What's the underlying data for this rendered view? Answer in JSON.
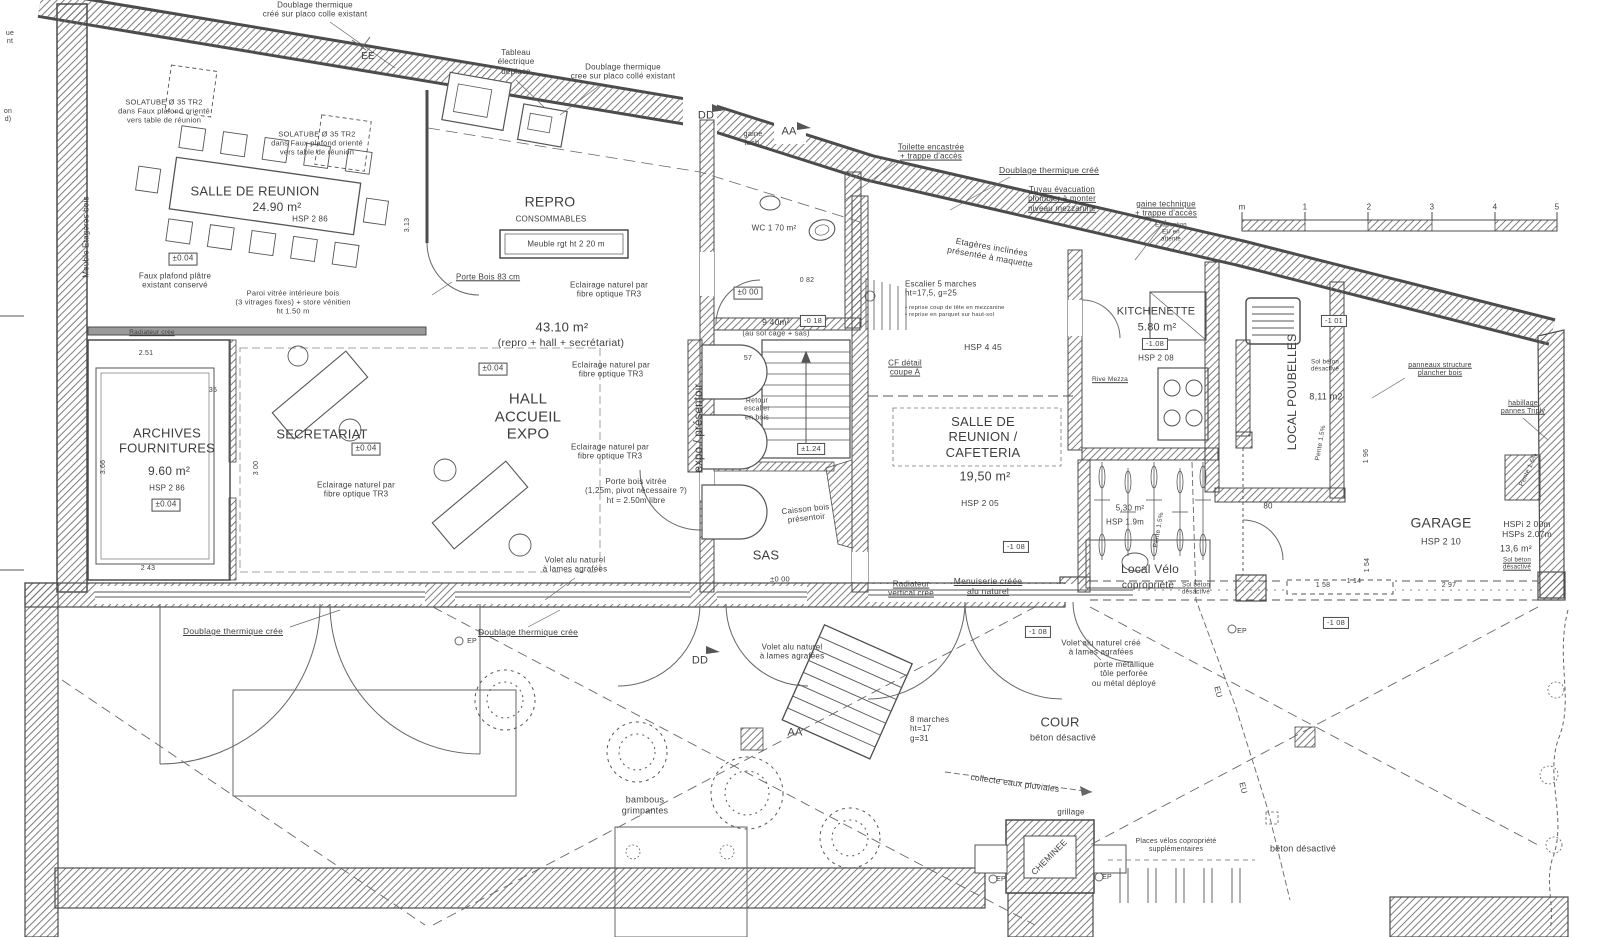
{
  "document": {
    "kind": "scanned architectural ground-floor plan (French)",
    "ink_color": "#3e3e3e",
    "paper_color": "#ffffff"
  },
  "scale_bar": {
    "unit": "m",
    "ticks": [
      "m",
      "1",
      "2",
      "3",
      "4",
      "5"
    ]
  },
  "rooms": [
    {
      "name": "SALLE DE REUNION",
      "area": "24.90 m²",
      "hsp": "HSP 2 86",
      "level": "±0.04"
    },
    {
      "name": "REPRO CONSOMMABLES"
    },
    {
      "name": "HALL ACCUEIL EXPO",
      "area": "43.10 m² (repro + hall + secrétariat)",
      "level": "±0.04"
    },
    {
      "name": "ARCHIVES FOURNITURES",
      "area": "9.60 m²",
      "hsp": "HSP 2 86",
      "level": "±0.04"
    },
    {
      "name": "SECRETARIAT",
      "level": "±0.04"
    },
    {
      "name": "WC",
      "area": "1 70 m²",
      "level": "±0 00"
    },
    {
      "name": "SALLE DE REUNION / CAFETERIA",
      "area": "19,50 m²",
      "hsp": "HSP 2 05"
    },
    {
      "name": "KITCHENETTE",
      "area": "5.80 m²",
      "hsp": "HSP 2 08",
      "level": "-1.08"
    },
    {
      "name": "SAS",
      "level": "±0 00"
    },
    {
      "name": "Local Vélo copropriété",
      "area": "5,30 m²",
      "hsp": "HSP 1.9m"
    },
    {
      "name": "LOCAL POUBELLES",
      "area": "8,11 m2",
      "level": "-1 01"
    },
    {
      "name": "GARAGE",
      "area": "13,6 m²",
      "hsp": "HSP 2 10",
      "level": "-1 08"
    },
    {
      "name": "COUR béton désactivé",
      "level": "-1 08"
    }
  ],
  "labels": [
    {
      "n": "note-doublage-top",
      "t": "Doublage thermique\ncréé sur placo colle existant",
      "x": 315,
      "y": 10,
      "s": 8
    },
    {
      "n": "marker-ee",
      "t": "EE",
      "x": 368,
      "y": 57,
      "s": 10
    },
    {
      "n": "note-solatube-1",
      "t": "SOLATUBE Ø 35     TR2\ndans Faux plafond orienté\nvers table de réunion",
      "x": 164,
      "y": 112,
      "s": 7.5
    },
    {
      "n": "note-solatube-2",
      "t": "SOLATUBE Ø 35    TR2\ndans Faux plafond orienté\nvers table de réunion",
      "x": 317,
      "y": 144,
      "s": 7.5
    },
    {
      "n": "room-salle-reunion",
      "t": "SALLE DE REUNION",
      "x": 255,
      "y": 191,
      "s": 13
    },
    {
      "n": "area-salle-reunion",
      "t": "24.90 m²",
      "x": 277,
      "y": 207,
      "s": 12
    },
    {
      "n": "hsp-salle-reunion",
      "t": "HSP 2 86",
      "x": 310,
      "y": 219,
      "s": 8
    },
    {
      "n": "lvl-reunion",
      "t": "±0.04",
      "x": 183,
      "y": 259,
      "s": 8,
      "b": true
    },
    {
      "n": "note-faux-plafond",
      "t": "Faux plafond plâtre\nexistant conservé",
      "x": 175,
      "y": 281,
      "s": 8
    },
    {
      "n": "lbl-meuble-etageres",
      "t": "Meuble Etagères bois",
      "x": 86,
      "y": 237,
      "s": 8,
      "r": -90
    },
    {
      "n": "frag-left-1",
      "t": "ue\nnt",
      "x": 10,
      "y": 38,
      "s": 7
    },
    {
      "n": "frag-left-2",
      "t": "on\nd)",
      "x": 8,
      "y": 116,
      "s": 7
    },
    {
      "n": "note-paroi-vitree",
      "t": "Paroi vitrée intérieure bois\n(3 vitrages fixes) + store vénitien\nht   1.50 m",
      "x": 293,
      "y": 303,
      "s": 7.5
    },
    {
      "n": "note-radiateur-cree",
      "t": "Radiateur crée",
      "x": 152,
      "y": 333,
      "s": 6.5,
      "u": true
    },
    {
      "n": "note-tableau-electrique",
      "t": "Tableau\nélectrique\ndéplace",
      "x": 516,
      "y": 62,
      "s": 8
    },
    {
      "n": "note-doublage-repro",
      "t": "Doublage thermique\ncree sur placo collé existant",
      "x": 623,
      "y": 72,
      "s": 8
    },
    {
      "n": "room-repro",
      "t": "REPRO",
      "x": 550,
      "y": 202,
      "s": 14
    },
    {
      "n": "sub-repro",
      "t": "CONSOMMABLES",
      "x": 551,
      "y": 219,
      "s": 8
    },
    {
      "n": "lbl-meuble-rgt",
      "t": "Meuble rgt   ht    2 20 m",
      "x": 566,
      "y": 244,
      "s": 8
    },
    {
      "n": "note-porte-bois-83",
      "t": "Porte Bois 83 cm",
      "x": 488,
      "y": 277,
      "s": 8,
      "u": true
    },
    {
      "n": "note-tr3-a",
      "t": "Eclairage naturel par\nfibre optique TR3",
      "x": 609,
      "y": 290,
      "s": 8
    },
    {
      "n": "area-hall",
      "t": "43.10 m²",
      "x": 562,
      "y": 327,
      "s": 13
    },
    {
      "n": "area-hall-sub",
      "t": "(repro + hall + secrétariat)",
      "x": 561,
      "y": 343,
      "s": 10.5
    },
    {
      "n": "lvl-hall",
      "t": "±0.04",
      "x": 493,
      "y": 369,
      "s": 8,
      "b": true
    },
    {
      "n": "room-hall",
      "t": "HALL\nACCUEIL\nEXPO",
      "x": 528,
      "y": 417,
      "s": 15
    },
    {
      "n": "note-tr3-b",
      "t": "Eclairage naturel par\nfibre optique TR3",
      "x": 611,
      "y": 370,
      "s": 8
    },
    {
      "n": "note-tr3-c",
      "t": "Eclairage naturel par\nfibre optique TR3",
      "x": 610,
      "y": 452,
      "s": 8
    },
    {
      "n": "note-porte-vitree",
      "t": "Porte bois vitrée\n(1,25m, pivot nécessaire ?)\nht = 2.50m   libre",
      "x": 636,
      "y": 491,
      "s": 8
    },
    {
      "n": "lbl-expo-presentoir",
      "t": "expo / présentoir",
      "x": 700,
      "y": 428,
      "s": 11.5,
      "r": -90
    },
    {
      "n": "marker-dd-top",
      "t": "DD",
      "x": 706,
      "y": 116,
      "s": 11
    },
    {
      "n": "lbl-gaine-tech",
      "t": "gaine\ntech.",
      "x": 753,
      "y": 139,
      "s": 7.5
    },
    {
      "n": "marker-aa-top",
      "t": "AA",
      "x": 789,
      "y": 132,
      "s": 11
    },
    {
      "n": "room-wc",
      "t": "WC   1 70 m²",
      "x": 774,
      "y": 228,
      "s": 8
    },
    {
      "n": "lvl-000-cage",
      "t": "±0 00",
      "x": 748,
      "y": 293,
      "s": 8,
      "b": true
    },
    {
      "n": "dim-082",
      "t": "0 82",
      "x": 807,
      "y": 281,
      "s": 7
    },
    {
      "n": "area-cage",
      "t": "9 40m²",
      "x": 776,
      "y": 322,
      "s": 8.5
    },
    {
      "n": "lvl-018",
      "t": "-0 18",
      "x": 813,
      "y": 321,
      "s": 7.5,
      "b": true
    },
    {
      "n": "sub-cage",
      "t": "(au sol   cage + sas)",
      "x": 776,
      "y": 334,
      "s": 7.5
    },
    {
      "n": "dim-57",
      "t": "57",
      "x": 748,
      "y": 359,
      "s": 7
    },
    {
      "n": "note-toilette",
      "t": "Toilette encastrée\n+ trappe d'accès",
      "x": 931,
      "y": 152,
      "s": 8,
      "u": true
    },
    {
      "n": "note-doublage-cree",
      "t": "Doublage thermique créé",
      "x": 1049,
      "y": 170,
      "s": 8.5,
      "u": true
    },
    {
      "n": "note-tuyau",
      "t": "Tuyau évacuation\nplombier à monter\nniveau mezzanine",
      "x": 1062,
      "y": 199,
      "s": 8,
      "u": true
    },
    {
      "n": "note-gaine-technique",
      "t": "gaine technique\n+ trappe d'accès",
      "x": 1166,
      "y": 209,
      "s": 8,
      "u": true
    },
    {
      "n": "note-evac-eu",
      "t": "Evacuation\nEU en\nattente",
      "x": 1171,
      "y": 233,
      "s": 6
    },
    {
      "n": "note-etageres-inclinees",
      "t": "Etagères inclinées\nprésentée à maquette",
      "x": 991,
      "y": 252,
      "s": 8.5,
      "r": 10
    },
    {
      "n": "note-escalier5",
      "t": "Escalier 5 marches\nht=17,5, g=25",
      "x": 905,
      "y": 289,
      "s": 8,
      "a": "l"
    },
    {
      "n": "note-escalier5-sub",
      "t": "• reprise coup de tête en mezzanine\n• reprise en parquet sur haut-sol",
      "x": 905,
      "y": 312,
      "s": 5.8,
      "a": "l"
    },
    {
      "n": "hsp-mezzanine",
      "t": "HSP 4 45",
      "x": 983,
      "y": 347,
      "s": 8.5
    },
    {
      "n": "note-cf-detail",
      "t": "CF détail\ncoupe A",
      "x": 905,
      "y": 368,
      "s": 8,
      "u": true
    },
    {
      "n": "room-kitchenette",
      "t": "KITCHENETTE",
      "x": 1156,
      "y": 312,
      "s": 11
    },
    {
      "n": "area-kitchenette",
      "t": "5.80 m²",
      "x": 1157,
      "y": 328,
      "s": 11
    },
    {
      "n": "lvl-kitchenette",
      "t": "-1.08",
      "x": 1155,
      "y": 344,
      "s": 7.5,
      "b": true
    },
    {
      "n": "hsp-kitchenette",
      "t": "HSP 2 08",
      "x": 1156,
      "y": 358,
      "s": 8
    },
    {
      "n": "lbl-rive-mezza",
      "t": "Rive Mezza",
      "x": 1110,
      "y": 380,
      "s": 6.5,
      "u": true
    },
    {
      "n": "room-cafeteria",
      "t": "SALLE DE\nREUNION /\nCAFETERIA",
      "x": 983,
      "y": 437,
      "s": 13
    },
    {
      "n": "area-cafeteria",
      "t": "19,50 m²",
      "x": 985,
      "y": 477,
      "s": 12.5
    },
    {
      "n": "hsp-cafeteria",
      "t": "HSP 2 05",
      "x": 980,
      "y": 503,
      "s": 8.5
    },
    {
      "n": "note-retour-escalier",
      "t": "Retour\nescalier\nen bois",
      "x": 757,
      "y": 410,
      "s": 7
    },
    {
      "n": "lvl-124",
      "t": "±1.24",
      "x": 811,
      "y": 449,
      "s": 7.5,
      "b": true
    },
    {
      "n": "note-caisson",
      "t": "Caisson bois\nprésentoir",
      "x": 806,
      "y": 514,
      "s": 8,
      "r": -6
    },
    {
      "n": "room-sas",
      "t": "SAS",
      "x": 766,
      "y": 555,
      "s": 13
    },
    {
      "n": "lvl-sas",
      "t": "±0 00",
      "x": 780,
      "y": 580,
      "s": 7.5
    },
    {
      "n": "note-radiateur-vertical",
      "t": "Radiateur\nvertical créé",
      "x": 911,
      "y": 589,
      "s": 8,
      "u": true
    },
    {
      "n": "note-menuiserie",
      "t": "Menuiserie créée\nalu naturel",
      "x": 988,
      "y": 586,
      "s": 8.5,
      "u": true
    },
    {
      "n": "lvl-108-cafeteria",
      "t": "-1 08",
      "x": 1016,
      "y": 547,
      "s": 7.5,
      "b": true
    },
    {
      "n": "note-doublage-bl",
      "t": "Doublage thermique crée",
      "x": 233,
      "y": 631,
      "s": 8.5,
      "u": true
    },
    {
      "n": "note-doublage-bm",
      "t": "Doublage thermique crée",
      "x": 528,
      "y": 632,
      "s": 8.5,
      "u": true
    },
    {
      "n": "lbl-ep-1",
      "t": "EP",
      "x": 472,
      "y": 642,
      "s": 7
    },
    {
      "n": "marker-dd-bottom",
      "t": "DD",
      "x": 700,
      "y": 661,
      "s": 11
    },
    {
      "n": "note-volet-1",
      "t": "Volet alu naturel\nà lames agrafées",
      "x": 575,
      "y": 565,
      "s": 8
    },
    {
      "n": "note-volet-2",
      "t": "Volet alu naturel\nà lames agrafées",
      "x": 792,
      "y": 652,
      "s": 8
    },
    {
      "n": "note-volet-3",
      "t": "Volet alu naturel créé\nà lames agrafées",
      "x": 1101,
      "y": 648,
      "s": 8
    },
    {
      "n": "lvl-108-cour",
      "t": "-1 08",
      "x": 1038,
      "y": 632,
      "s": 7.5,
      "b": true
    },
    {
      "n": "note-porte-metal",
      "t": "porte métallique\ntôle perforée\nou métal déployé",
      "x": 1124,
      "y": 674,
      "s": 8
    },
    {
      "n": "marker-aa-bottom",
      "t": "AA",
      "x": 795,
      "y": 733,
      "s": 11
    },
    {
      "n": "note-8-marches",
      "t": "8 marches\nht=17\ng=31",
      "x": 910,
      "y": 729,
      "s": 8,
      "a": "l"
    },
    {
      "n": "room-cour",
      "t": "COUR",
      "x": 1060,
      "y": 722,
      "s": 13
    },
    {
      "n": "sub-cour",
      "t": "béton désactivé",
      "x": 1063,
      "y": 738,
      "s": 9
    },
    {
      "n": "note-collecte-eaux",
      "t": "collecte eaux pluviales",
      "x": 1015,
      "y": 783,
      "s": 8.5,
      "r": 8
    },
    {
      "n": "lbl-grillage",
      "t": "grillage",
      "x": 1071,
      "y": 812,
      "s": 8
    },
    {
      "n": "lbl-cheminee",
      "t": "CHEMINEE",
      "x": 1049,
      "y": 857,
      "s": 8.5,
      "r": -45
    },
    {
      "n": "lbl-ep-2",
      "t": "EP",
      "x": 1001,
      "y": 880,
      "s": 7
    },
    {
      "n": "lbl-ep-3",
      "t": "EP",
      "x": 1107,
      "y": 878,
      "s": 7
    },
    {
      "n": "note-places-velos",
      "t": "Places vélos copropriété\nsupplémentaires",
      "x": 1176,
      "y": 846,
      "s": 7
    },
    {
      "n": "lbl-beton-br",
      "t": "béton désactivé",
      "x": 1303,
      "y": 849,
      "s": 9
    },
    {
      "n": "lbl-eu-1",
      "t": "EU",
      "x": 1218,
      "y": 692,
      "s": 8,
      "r": 75
    },
    {
      "n": "lbl-eu-2",
      "t": "EU",
      "x": 1243,
      "y": 788,
      "s": 8,
      "r": 75
    },
    {
      "n": "lbl-bambous",
      "t": "bambous\ngrimpantes",
      "x": 645,
      "y": 805,
      "s": 9
    },
    {
      "n": "room-local-velo",
      "t": "Local Vélo",
      "x": 1150,
      "y": 569,
      "s": 12
    },
    {
      "n": "sub-local-velo",
      "t": "copropriété",
      "x": 1148,
      "y": 586,
      "s": 10
    },
    {
      "n": "area-velo",
      "t": "5,30 m²",
      "x": 1130,
      "y": 508,
      "s": 8
    },
    {
      "n": "hsp-velo",
      "t": "HSP 1.9m",
      "x": 1125,
      "y": 522,
      "s": 8
    },
    {
      "n": "note-sol-beton-velo",
      "t": "Sol béton\ndésactivé",
      "x": 1196,
      "y": 589,
      "s": 6.2
    },
    {
      "n": "dim-80",
      "t": "80",
      "x": 1268,
      "y": 506,
      "s": 8
    },
    {
      "n": "lbl-ep-4",
      "t": "EP",
      "x": 1242,
      "y": 632,
      "s": 7
    },
    {
      "n": "pente-velo",
      "t": "Pente 1.5%",
      "x": 1159,
      "y": 530,
      "s": 6.5,
      "r": -80
    },
    {
      "n": "room-local-poubelles",
      "t": "LOCAL POUBELLES",
      "x": 1292,
      "y": 392,
      "s": 12,
      "r": -90
    },
    {
      "n": "note-sol-beton-poubelles",
      "t": "Sol béton\ndésactivé",
      "x": 1325,
      "y": 366,
      "s": 6.2
    },
    {
      "n": "area-poubelles",
      "t": "8,11 m2",
      "x": 1326,
      "y": 397,
      "s": 9
    },
    {
      "n": "lvl-101",
      "t": "-1 01",
      "x": 1334,
      "y": 321,
      "s": 7.5,
      "b": true
    },
    {
      "n": "pente-poubelles",
      "t": "Pente 1.5%",
      "x": 1321,
      "y": 443,
      "s": 6.5,
      "r": -80
    },
    {
      "n": "note-panneaux",
      "t": "panneaux structure\nplancher bois",
      "x": 1440,
      "y": 370,
      "s": 7,
      "u": true
    },
    {
      "n": "note-habillage",
      "t": "habillage\npannes Triply",
      "x": 1523,
      "y": 408,
      "s": 7,
      "u": true
    },
    {
      "n": "room-garage",
      "t": "GARAGE",
      "x": 1441,
      "y": 523,
      "s": 14
    },
    {
      "n": "hsp-garage",
      "t": "HSP 2 10",
      "x": 1441,
      "y": 542,
      "s": 9
    },
    {
      "n": "hsp-garage-2",
      "t": "HSPi  2 00m\nHSPs  2.07m",
      "x": 1527,
      "y": 529,
      "s": 8.5
    },
    {
      "n": "area-garage",
      "t": "13,6 m²",
      "x": 1516,
      "y": 549,
      "s": 9
    },
    {
      "n": "note-sol-beton-garage",
      "t": "Sol béton\ndésactivé",
      "x": 1517,
      "y": 564,
      "s": 6.2,
      "u": true
    },
    {
      "n": "pente-garage",
      "t": "Pente 1.5%",
      "x": 1529,
      "y": 470,
      "s": 6.5,
      "r": -65
    },
    {
      "n": "dim-158",
      "t": "1 58",
      "x": 1323,
      "y": 586,
      "s": 7
    },
    {
      "n": "dim-114",
      "t": "1 14",
      "x": 1354,
      "y": 582,
      "s": 7
    },
    {
      "n": "dim-154",
      "t": "1 54",
      "x": 1368,
      "y": 565,
      "s": 7,
      "r": -90
    },
    {
      "n": "dim-196",
      "t": "1 96",
      "x": 1367,
      "y": 456,
      "s": 7,
      "r": -90
    },
    {
      "n": "dim-297",
      "t": "2 97",
      "x": 1449,
      "y": 586,
      "s": 7
    },
    {
      "n": "lvl-108-garage",
      "t": "-1 08",
      "x": 1336,
      "y": 623,
      "s": 7.5,
      "b": true
    },
    {
      "n": "room-archives",
      "t": "ARCHIVES\nFOURNITURES",
      "x": 167,
      "y": 441,
      "s": 13
    },
    {
      "n": "area-archives",
      "t": "9.60 m²",
      "x": 169,
      "y": 471,
      "s": 12
    },
    {
      "n": "hsp-archives",
      "t": "HSP 2 86",
      "x": 167,
      "y": 488,
      "s": 8
    },
    {
      "n": "lvl-archives",
      "t": "±0.04",
      "x": 166,
      "y": 505,
      "s": 8,
      "b": true
    },
    {
      "n": "room-secretariat",
      "t": "SECRETARIAT",
      "x": 322,
      "y": 434,
      "s": 13
    },
    {
      "n": "lvl-secretariat",
      "t": "±0.04",
      "x": 366,
      "y": 449,
      "s": 8,
      "b": true
    },
    {
      "n": "note-tr3-d",
      "t": "Eclairage naturel par\nfibre optique TR3",
      "x": 356,
      "y": 490,
      "s": 8
    },
    {
      "n": "dim-251",
      "t": "2.51",
      "x": 146,
      "y": 354,
      "s": 7
    },
    {
      "n": "dim-35",
      "t": "35",
      "x": 213,
      "y": 391,
      "s": 7
    },
    {
      "n": "dim-300",
      "t": "3 00",
      "x": 257,
      "y": 468,
      "s": 7,
      "r": -90
    },
    {
      "n": "dim-366",
      "t": "3.66",
      "x": 104,
      "y": 467,
      "s": 7,
      "r": -90
    },
    {
      "n": "dim-243",
      "t": "2 43",
      "x": 148,
      "y": 569,
      "s": 7
    },
    {
      "n": "dim-313",
      "t": "3.13",
      "x": 408,
      "y": 225,
      "s": 7,
      "r": -90
    },
    {
      "n": "scale-tick-m",
      "t": "m",
      "x": 1242,
      "y": 207,
      "s": 8
    },
    {
      "n": "scale-tick-1",
      "t": "1",
      "x": 1305,
      "y": 207,
      "s": 8
    },
    {
      "n": "scale-tick-2",
      "t": "2",
      "x": 1369,
      "y": 207,
      "s": 8
    },
    {
      "n": "scale-tick-3",
      "t": "3",
      "x": 1432,
      "y": 207,
      "s": 8
    },
    {
      "n": "scale-tick-4",
      "t": "4",
      "x": 1495,
      "y": 207,
      "s": 8
    },
    {
      "n": "scale-tick-5",
      "t": "5",
      "x": 1557,
      "y": 207,
      "s": 8
    }
  ]
}
